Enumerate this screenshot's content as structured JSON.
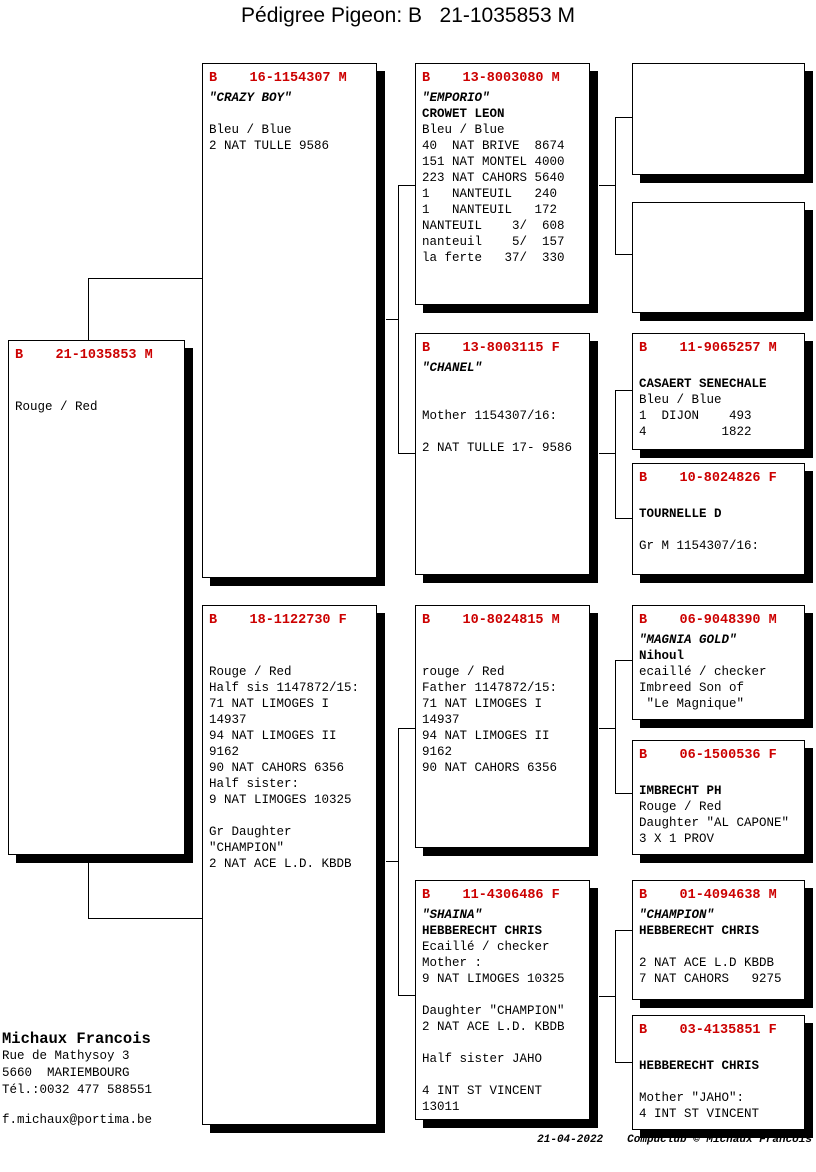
{
  "title": "Pédigree Pigeon: B   21-1035853 M",
  "colors": {
    "ring_red": "#cc0000"
  },
  "boxes": {
    "subject": {
      "ring": "B    21-1035853 M",
      "lines": [
        "",
        "",
        "Rouge / Red"
      ]
    },
    "sire": {
      "ring": "B    16-1154307 M",
      "lines": [
        "\"CRAZY BOY\"",
        "",
        "Bleu / Blue",
        "2 NAT TULLE 9586"
      ]
    },
    "dam": {
      "ring": "B    18-1122730 F",
      "lines": [
        "",
        "",
        "Rouge / Red",
        "Half sis 1147872/15:",
        "71 NAT LIMOGES I",
        "14937",
        "94 NAT LIMOGES II",
        "9162",
        "90 NAT CAHORS 6356",
        "Half sister:",
        "9 NAT LIMOGES 10325",
        "",
        "Gr Daughter",
        "\"CHAMPION\"",
        "2 NAT ACE L.D. KBDB"
      ]
    },
    "sire_sire": {
      "ring": "B    13-8003080 M",
      "lines": [
        "\"EMPORIO\"",
        "CROWET LEON",
        "Bleu / Blue",
        "40  NAT BRIVE  8674",
        "151 NAT MONTEL 4000",
        "223 NAT CAHORS 5640",
        "1   NANTEUIL   240",
        "1   NANTEUIL   172",
        "NANTEUIL    3/  608",
        "nanteuil    5/  157",
        "la ferte   37/  330"
      ]
    },
    "sire_dam": {
      "ring": "B    13-8003115 F",
      "lines": [
        "\"CHANEL\"",
        "",
        "",
        "Mother 1154307/16:",
        "",
        "2 NAT TULLE 17- 9586"
      ]
    },
    "dam_sire": {
      "ring": "B    10-8024815 M",
      "lines": [
        "",
        "",
        "rouge / Red",
        "Father 1147872/15:",
        "71 NAT LIMOGES I",
        "14937",
        "94 NAT LIMOGES II",
        "9162",
        "90 NAT CAHORS 6356"
      ]
    },
    "dam_dam": {
      "ring": "B    11-4306486 F",
      "lines": [
        "\"SHAINA\"",
        "HEBBERECHT CHRIS",
        "Ecaillé / checker",
        "Mother :",
        "9 NAT LIMOGES 10325",
        "",
        "Daughter \"CHAMPION\"",
        "2 NAT ACE L.D. KBDB",
        "",
        "Half sister JAHO",
        "",
        "4 INT ST VINCENT",
        "13011"
      ]
    },
    "sire_dam_sire": {
      "ring": "B    11-9065257 M",
      "lines": [
        "",
        "CASAERT SENECHALE",
        "Bleu / Blue",
        "1  DIJON    493",
        "4          1822"
      ]
    },
    "sire_dam_dam": {
      "ring": "B    10-8024826 F",
      "lines": [
        "",
        "TOURNELLE D",
        "",
        "Gr M 1154307/16:"
      ]
    },
    "dam_sire_sire": {
      "ring": "B    06-9048390 M",
      "lines": [
        "\"MAGNIA GOLD\"",
        "Nihoul",
        "ecaillé / checker",
        "Imbreed Son of",
        " \"Le Magnique\""
      ]
    },
    "dam_sire_dam": {
      "ring": "B    06-1500536 F",
      "lines": [
        "",
        "IMBRECHT PH",
        "Rouge / Red",
        "Daughter \"AL CAPONE\"",
        "3 X 1 PROV"
      ]
    },
    "dam_dam_sire": {
      "ring": "B    01-4094638 M",
      "lines": [
        "\"CHAMPION\"",
        "HEBBERECHT CHRIS",
        "",
        "2 NAT ACE L.D KBDB",
        "7 NAT CAHORS   9275"
      ]
    },
    "dam_dam_dam": {
      "ring": "B    03-4135851 F",
      "lines": [
        "",
        "HEBBERECHT CHRIS",
        "",
        "Mother \"JAHO\":",
        "4 INT ST VINCENT"
      ]
    }
  },
  "owner": {
    "name": "Michaux Francois",
    "address_line1": "Rue de Mathysoy 3",
    "address_line2": "5660  MARIEMBOURG",
    "phone": "Tél.:0032 477 588551",
    "email": "f.michaux@portima.be"
  },
  "footer": {
    "date": "21-04-2022",
    "credit": "Compuclub © Michaux Francois"
  }
}
